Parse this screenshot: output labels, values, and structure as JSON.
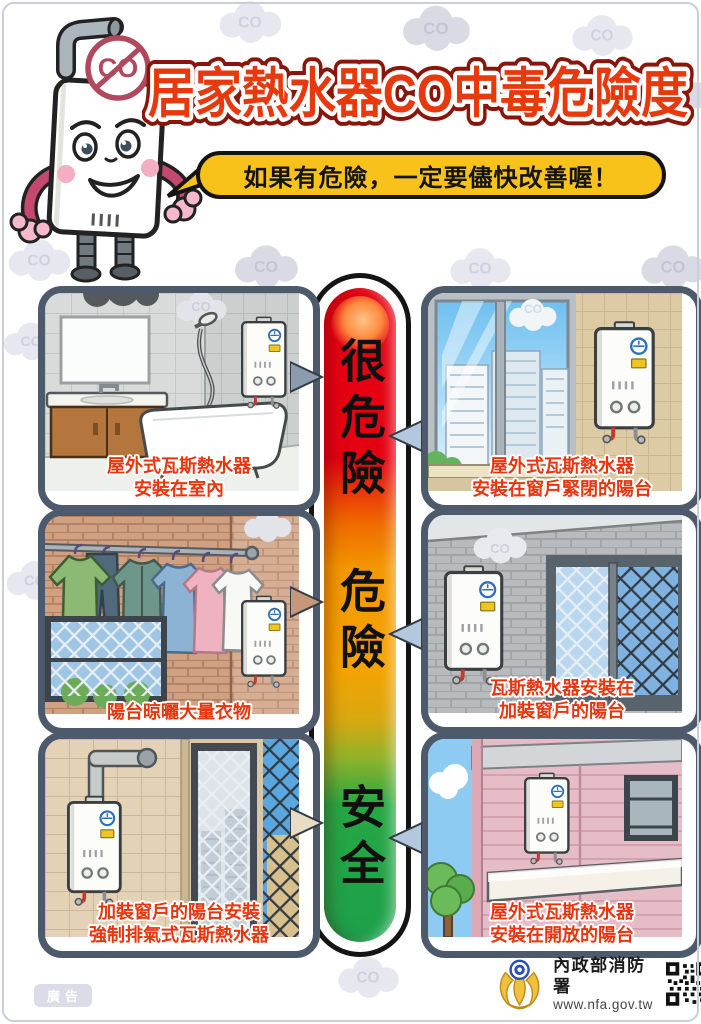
{
  "title": "居家熱水器CO中毒危險度",
  "speech_bubble": "如果有危險，一定要儘快改善喔！",
  "cloud_label": "CO",
  "mascot": {
    "badge": "CO"
  },
  "scale": {
    "levels": [
      {
        "label": "很危險",
        "color": "#e50012"
      },
      {
        "label": "危險",
        "color": "#f39800"
      },
      {
        "label": "安全",
        "color": "#22a644"
      }
    ]
  },
  "panels": [
    {
      "level": "很危險",
      "caption": [
        "屋外式瓦斯熱水器",
        "安裝在室內"
      ]
    },
    {
      "level": "很危險",
      "caption": [
        "屋外式瓦斯熱水器",
        "安裝在窗戶緊閉的陽台"
      ]
    },
    {
      "level": "危險",
      "caption": [
        "陽台晾曬大量衣物"
      ]
    },
    {
      "level": "危險",
      "caption": [
        "瓦斯熱水器安裝在",
        "加裝窗戶的陽台"
      ]
    },
    {
      "level": "安全",
      "caption": [
        "加裝窗戶的陽台安裝",
        "強制排氣式瓦斯熱水器"
      ]
    },
    {
      "level": "安全",
      "caption": [
        "屋外式瓦斯熱水器",
        "安裝在開放的陽台"
      ]
    }
  ],
  "footer": {
    "agency": "內政部消防署",
    "website": "www.nfa.gov.tw"
  },
  "ad_label": "廣告",
  "colors": {
    "title_red": "#e8380d",
    "bubble_yellow": "#f9c21a",
    "panel_border": "#4d5a6b",
    "caption_red": "#e8350e"
  }
}
